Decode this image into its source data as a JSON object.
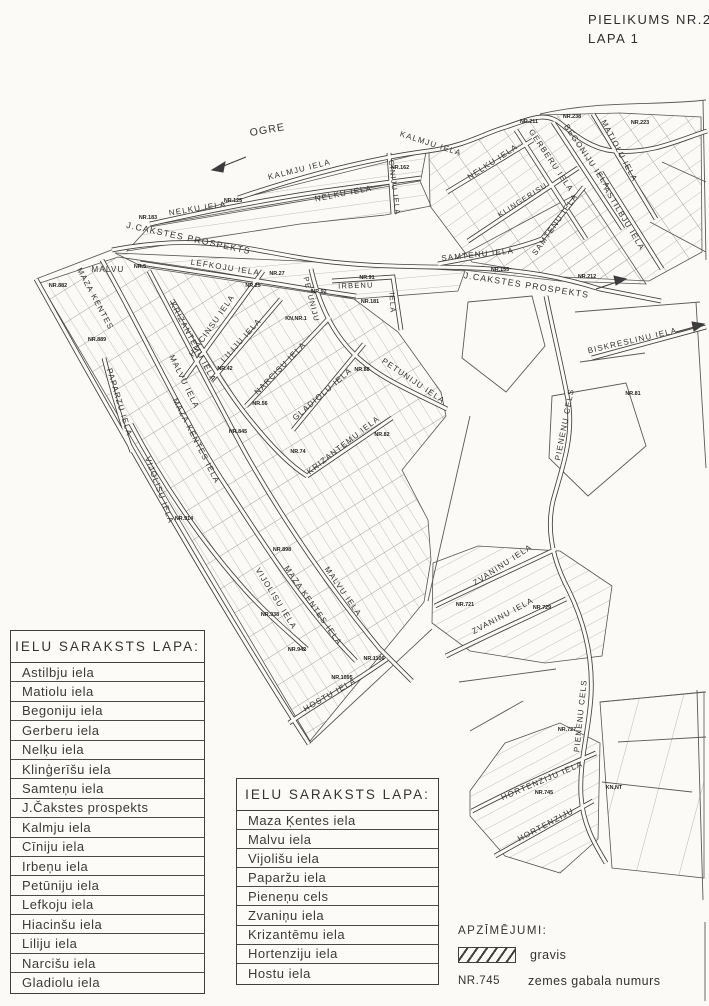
{
  "title": {
    "line1": "PIELIKUMS NR.2",
    "line2": "LAPA 1"
  },
  "tables": {
    "left": {
      "header": "IELU SARAKSTS LAPA:",
      "rows": [
        "Astilbju iela",
        "Matiolu iela",
        "Begoniju iela",
        "Gerberu iela",
        "Nelķu iela",
        "Klinģerīšu iela",
        "Samteņu iela",
        "J.Čakstes prospekts",
        "Kalmju iela",
        "Cīniju iela",
        "Irbeņu iela",
        "Petūniju iela",
        "Lefkoju iela",
        "Hiacinšu iela",
        "Liliju iela",
        "Narcišu iela",
        "Gladiolu iela"
      ]
    },
    "middle": {
      "header": "IELU SARAKSTS LAPA:",
      "rows": [
        "Maza Ķentes iela",
        "Malvu iela",
        "Vijolišu iela",
        "Paparžu iela",
        "Pieneņu cels",
        "Zvaniņu iela",
        "Krizantēmu iela",
        "Hortenziju iela",
        "Hostu iela"
      ]
    }
  },
  "legend": {
    "title": "APZĪMĒJUMI:",
    "items": [
      {
        "symbol": "hatch",
        "label": "gravis"
      },
      {
        "symbol": "NR.745",
        "label": "zemes gabala numurs"
      }
    ]
  },
  "map": {
    "street_labels": [
      {
        "t": "OGRE",
        "x": 268,
        "y": 133,
        "r": -10,
        "s": 10.5,
        "ls": 6
      },
      {
        "t": "KALMJU IELA",
        "x": 300,
        "y": 172,
        "r": -14,
        "s": 8
      },
      {
        "t": "KALMJU IELA",
        "x": 430,
        "y": 146,
        "r": 18,
        "s": 8
      },
      {
        "t": "NELKU IELA",
        "x": 198,
        "y": 211,
        "r": -9,
        "s": 8
      },
      {
        "t": "NELKU IELA",
        "x": 344,
        "y": 196,
        "r": -11,
        "s": 8
      },
      {
        "t": "CINIJU IELA",
        "x": 392,
        "y": 188,
        "r": 83,
        "s": 7.5
      },
      {
        "t": "J.CAKSTES PROSPEKTS",
        "x": 188,
        "y": 241,
        "r": 12,
        "s": 8.8
      },
      {
        "t": "J.CAKSTES PROSPEKTS",
        "x": 526,
        "y": 288,
        "r": 9,
        "s": 8.8
      },
      {
        "t": "NELKU IELA",
        "x": 494,
        "y": 164,
        "r": -33,
        "s": 8
      },
      {
        "t": "KLINGERISU",
        "x": 524,
        "y": 202,
        "r": -33,
        "s": 7.5
      },
      {
        "t": "GERBERU IELA",
        "x": 549,
        "y": 162,
        "r": 56,
        "s": 8
      },
      {
        "t": "BEGONIJU IELA",
        "x": 585,
        "y": 158,
        "r": 56,
        "s": 8
      },
      {
        "t": "MATIOLU IELA",
        "x": 617,
        "y": 152,
        "r": 62,
        "s": 8
      },
      {
        "t": "ASTILBJU IELA",
        "x": 622,
        "y": 220,
        "r": 59,
        "s": 8
      },
      {
        "t": "SAMTENU IELA",
        "x": 478,
        "y": 257,
        "r": -6,
        "s": 8
      },
      {
        "t": "SAMTENU IELA",
        "x": 557,
        "y": 226,
        "r": -55,
        "s": 8
      },
      {
        "t": "LEFKOJU IELA",
        "x": 225,
        "y": 270,
        "r": 9,
        "s": 8
      },
      {
        "t": "IRBENU",
        "x": 356,
        "y": 288,
        "r": -2,
        "s": 7.5
      },
      {
        "t": "IELA",
        "x": 390,
        "y": 303,
        "r": 87,
        "s": 7.5
      },
      {
        "t": "PETUNIJU",
        "x": 309,
        "y": 300,
        "r": 76,
        "s": 7.5
      },
      {
        "t": "MALVU",
        "x": 108,
        "y": 272,
        "r": 0,
        "s": 8
      },
      {
        "t": "MAZA KENTES",
        "x": 93,
        "y": 300,
        "r": 62,
        "s": 8
      },
      {
        "t": "KRIZANTEMU IELA",
        "x": 191,
        "y": 343,
        "r": 62,
        "s": 8
      },
      {
        "t": "HIACINSU IELA",
        "x": 214,
        "y": 327,
        "r": -55,
        "s": 8
      },
      {
        "t": "LILIJU IELA",
        "x": 243,
        "y": 342,
        "r": -48,
        "s": 8
      },
      {
        "t": "NARCISU IELA",
        "x": 282,
        "y": 370,
        "r": -46,
        "s": 8
      },
      {
        "t": "GLADIOLU IELA",
        "x": 324,
        "y": 396,
        "r": -41,
        "s": 8
      },
      {
        "t": "PETUNIJU IELA",
        "x": 412,
        "y": 383,
        "r": 34,
        "s": 8
      },
      {
        "t": "MALVU IELA",
        "x": 182,
        "y": 383,
        "r": 64,
        "s": 8
      },
      {
        "t": "MAZA KENTES IELA",
        "x": 194,
        "y": 442,
        "r": 63,
        "s": 8
      },
      {
        "t": "PAPARZU IELA",
        "x": 117,
        "y": 403,
        "r": 73,
        "s": 8
      },
      {
        "t": "VIJOLISU IELA",
        "x": 157,
        "y": 491,
        "r": 70,
        "s": 8
      },
      {
        "t": "VIJOLISU IELA",
        "x": 274,
        "y": 600,
        "r": 58,
        "s": 8
      },
      {
        "t": "MAZA KENTES IELA",
        "x": 311,
        "y": 607,
        "r": 55,
        "s": 8
      },
      {
        "t": "MALVU IELA",
        "x": 341,
        "y": 593,
        "r": 55,
        "s": 8
      },
      {
        "t": "KRIZANTEMU IELA",
        "x": 345,
        "y": 447,
        "r": -38,
        "s": 8
      },
      {
        "t": "HOSTU IELA",
        "x": 331,
        "y": 697,
        "r": -30,
        "s": 8
      },
      {
        "t": "PIENENU CELS",
        "x": 567,
        "y": 425,
        "r": -79,
        "s": 8
      },
      {
        "t": "PIENENU CELS",
        "x": 583,
        "y": 716,
        "r": -84,
        "s": 8
      },
      {
        "t": "BISKRESLINU IELA",
        "x": 633,
        "y": 343,
        "r": -13,
        "s": 8
      },
      {
        "t": "ZVANINU IELA",
        "x": 504,
        "y": 567,
        "r": -33,
        "s": 8
      },
      {
        "t": "ZVANINU IELA",
        "x": 504,
        "y": 618,
        "r": -28,
        "s": 8
      },
      {
        "t": "HORTENZIJU IELA",
        "x": 543,
        "y": 783,
        "r": -23,
        "s": 8
      },
      {
        "t": "HORTENZIJU",
        "x": 547,
        "y": 827,
        "r": -28,
        "s": 8
      }
    ],
    "parcel_labels": [
      {
        "t": "NR.183",
        "x": 148,
        "y": 219
      },
      {
        "t": "NR.125",
        "x": 233,
        "y": 202
      },
      {
        "t": "NR.162",
        "x": 400,
        "y": 169
      },
      {
        "t": "NR.211",
        "x": 529,
        "y": 123
      },
      {
        "t": "NR.238",
        "x": 572,
        "y": 118
      },
      {
        "t": "NR.223",
        "x": 640,
        "y": 124
      },
      {
        "t": "NR.882",
        "x": 58,
        "y": 287
      },
      {
        "t": "NR.5",
        "x": 140,
        "y": 268
      },
      {
        "t": "NR.27",
        "x": 277,
        "y": 275
      },
      {
        "t": "NR.25",
        "x": 253,
        "y": 287
      },
      {
        "t": "NR.92",
        "x": 319,
        "y": 293
      },
      {
        "t": "NR.91",
        "x": 367,
        "y": 279
      },
      {
        "t": "NR.181",
        "x": 370,
        "y": 303
      },
      {
        "t": "NR.155",
        "x": 500,
        "y": 271
      },
      {
        "t": "NR.212",
        "x": 587,
        "y": 278
      },
      {
        "t": "KN,NR.1",
        "x": 296,
        "y": 320
      },
      {
        "t": "NR.889",
        "x": 97,
        "y": 341
      },
      {
        "t": "NR.42",
        "x": 225,
        "y": 370
      },
      {
        "t": "NR.56",
        "x": 260,
        "y": 405
      },
      {
        "t": "NR.88",
        "x": 362,
        "y": 371
      },
      {
        "t": "NR.845",
        "x": 238,
        "y": 433
      },
      {
        "t": "NR.82",
        "x": 382,
        "y": 436
      },
      {
        "t": "NR.74",
        "x": 298,
        "y": 453
      },
      {
        "t": "NR.81",
        "x": 633,
        "y": 395
      },
      {
        "t": "NR.914",
        "x": 184,
        "y": 520
      },
      {
        "t": "NR.898",
        "x": 282,
        "y": 551
      },
      {
        "t": "NR.938",
        "x": 270,
        "y": 616
      },
      {
        "t": "NR.942",
        "x": 297,
        "y": 651
      },
      {
        "t": "NR.1106",
        "x": 374,
        "y": 660
      },
      {
        "t": "NR.1095",
        "x": 342,
        "y": 679
      },
      {
        "t": "NR.721",
        "x": 465,
        "y": 606
      },
      {
        "t": "NR.729",
        "x": 542,
        "y": 609
      },
      {
        "t": "NR.727",
        "x": 567,
        "y": 731
      },
      {
        "t": "NR.745",
        "x": 544,
        "y": 794
      },
      {
        "t": "KN,NT",
        "x": 614,
        "y": 789
      }
    ]
  }
}
